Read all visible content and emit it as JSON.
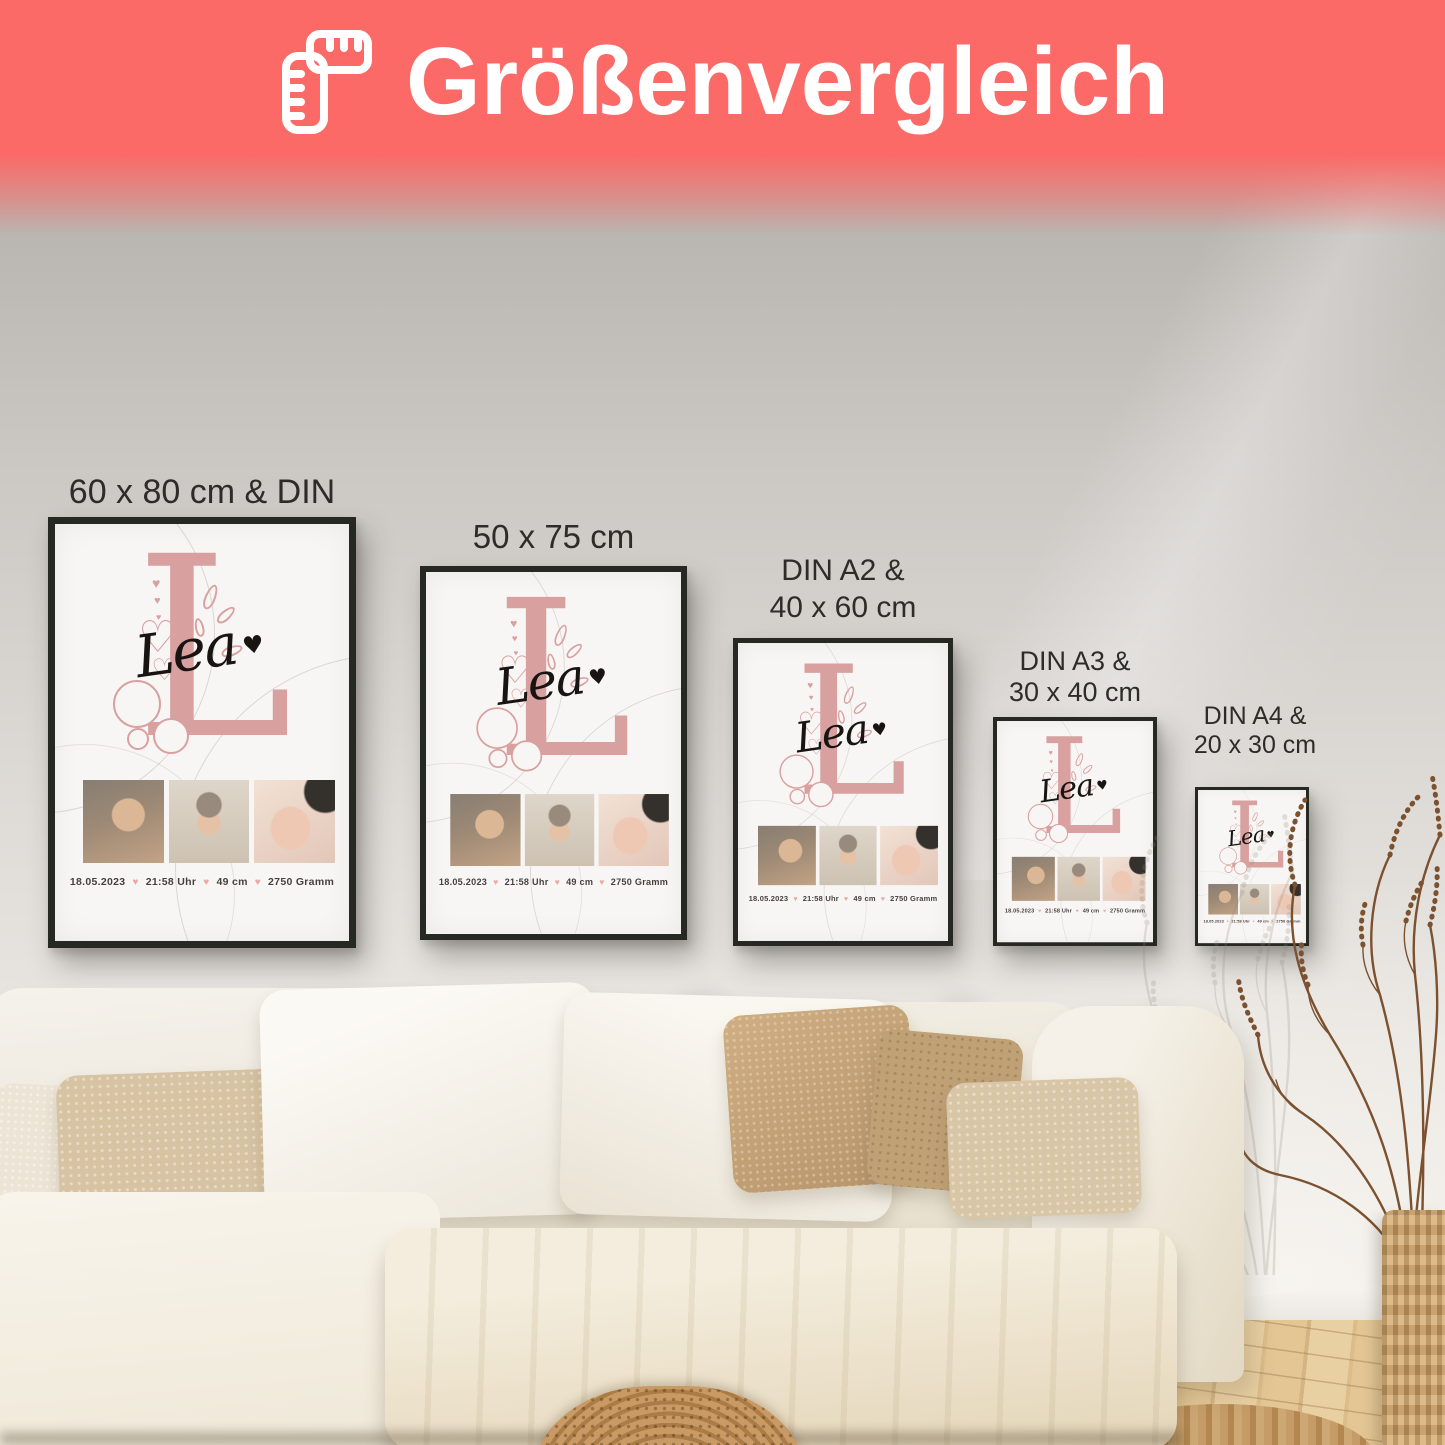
{
  "header": {
    "title": "Größenvergleich",
    "icon": "ruler-icon",
    "banner_color": "#fb6a66",
    "text_color": "#ffffff"
  },
  "posters": [
    {
      "label_lines": [
        "60 x 80 cm & DIN A1"
      ]
    },
    {
      "label_lines": [
        "50 x 75 cm"
      ]
    },
    {
      "label_lines": [
        "DIN A2 &",
        "40 x 60 cm"
      ]
    },
    {
      "label_lines": [
        "DIN A3 &",
        "30 x 40 cm"
      ]
    },
    {
      "label_lines": [
        "DIN A4 &",
        "20 x 30 cm"
      ]
    }
  ],
  "poster_content": {
    "initial": "L",
    "name": "Lea",
    "heart": "♥",
    "heart_outline": "♡",
    "birth_date": "18.05.2023",
    "birth_time": "21:58 Uhr",
    "length": "49 cm",
    "weight": "2750 Gramm"
  },
  "colors": {
    "accent_coral": "#fb6a66",
    "monogram_pink": "#d8a1a0",
    "stats_heart_pink": "#eaa9a7",
    "frame_dark": "#262921",
    "wall_gray": "#cbc8c4"
  }
}
